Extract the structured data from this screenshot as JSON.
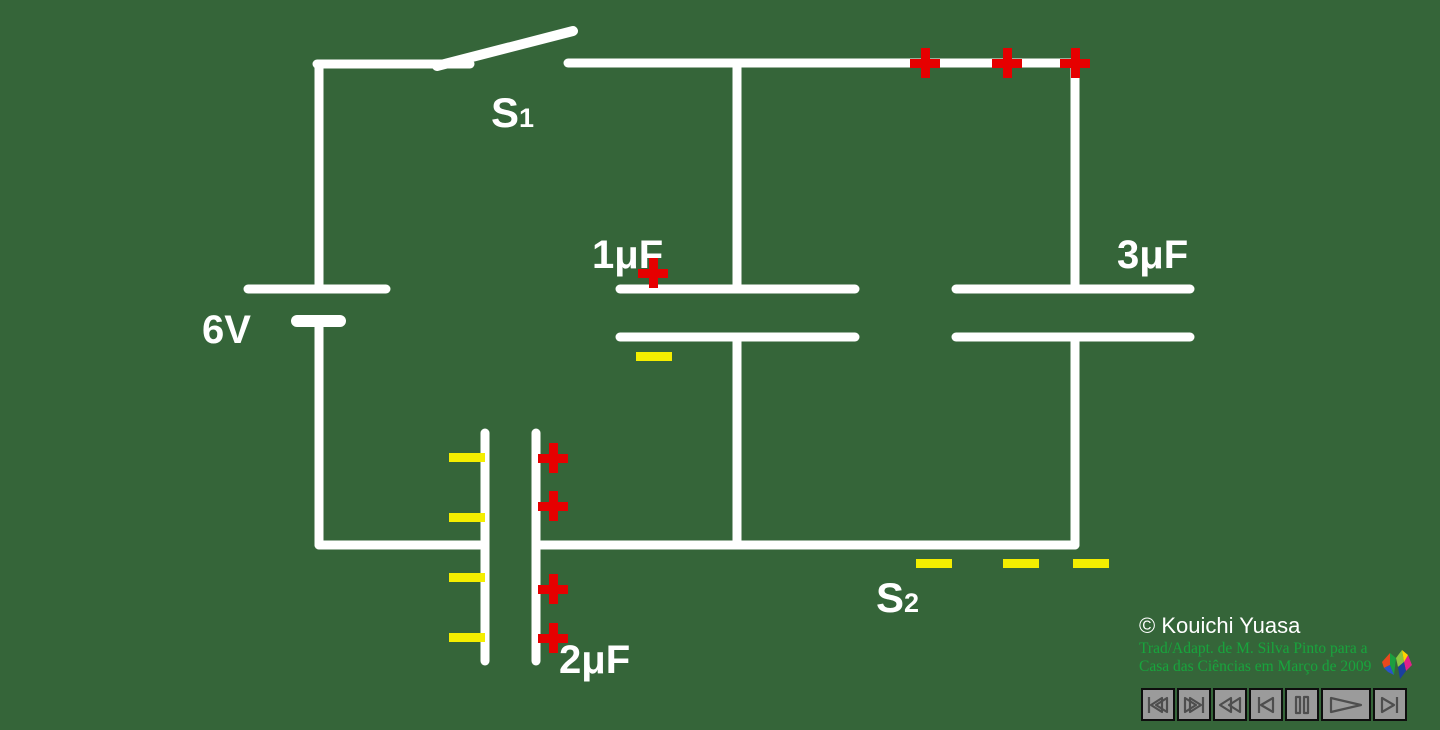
{
  "app": {
    "background_color": "#356539",
    "wire_color": "#ffffff"
  },
  "circuit": {
    "battery": {
      "label": "6V"
    },
    "switch_s1": {
      "label": "S",
      "sub": "1",
      "state": "open"
    },
    "switch_s2": {
      "label": "S",
      "sub": "2",
      "state": "closed"
    },
    "capacitor_c1": {
      "label": "1μF"
    },
    "capacitor_c2": {
      "label": "2μF"
    },
    "capacitor_c3": {
      "label": "3μF"
    }
  },
  "charges": {
    "positive_symbol": "+",
    "negative_symbol": "−",
    "positive_color": "#e60000",
    "negative_color": "#f4ee00",
    "plus_positions": [
      [
        925,
        63
      ],
      [
        1007,
        63
      ],
      [
        1075,
        63
      ],
      [
        653,
        273
      ],
      [
        553,
        458
      ],
      [
        553,
        506
      ],
      [
        553,
        589
      ],
      [
        553,
        638
      ]
    ],
    "minus_positions": [
      [
        654,
        356
      ],
      [
        467,
        457
      ],
      [
        467,
        517
      ],
      [
        467,
        577
      ],
      [
        467,
        637
      ],
      [
        934,
        563
      ],
      [
        1021,
        563
      ],
      [
        1091,
        563
      ]
    ]
  },
  "credits": {
    "copyright": "© Kouichi Yuasa",
    "translation_line1": "Trad/Adapt. de M. Silva Pinto para a",
    "translation_line2": "Casa das Ciências em Março de 2009"
  },
  "controls": {
    "buttons": [
      {
        "name": "go-to-start"
      },
      {
        "name": "go-to-end"
      },
      {
        "name": "fast-rewind"
      },
      {
        "name": "step-back"
      },
      {
        "name": "pause"
      },
      {
        "name": "play"
      },
      {
        "name": "step-forward"
      }
    ]
  }
}
